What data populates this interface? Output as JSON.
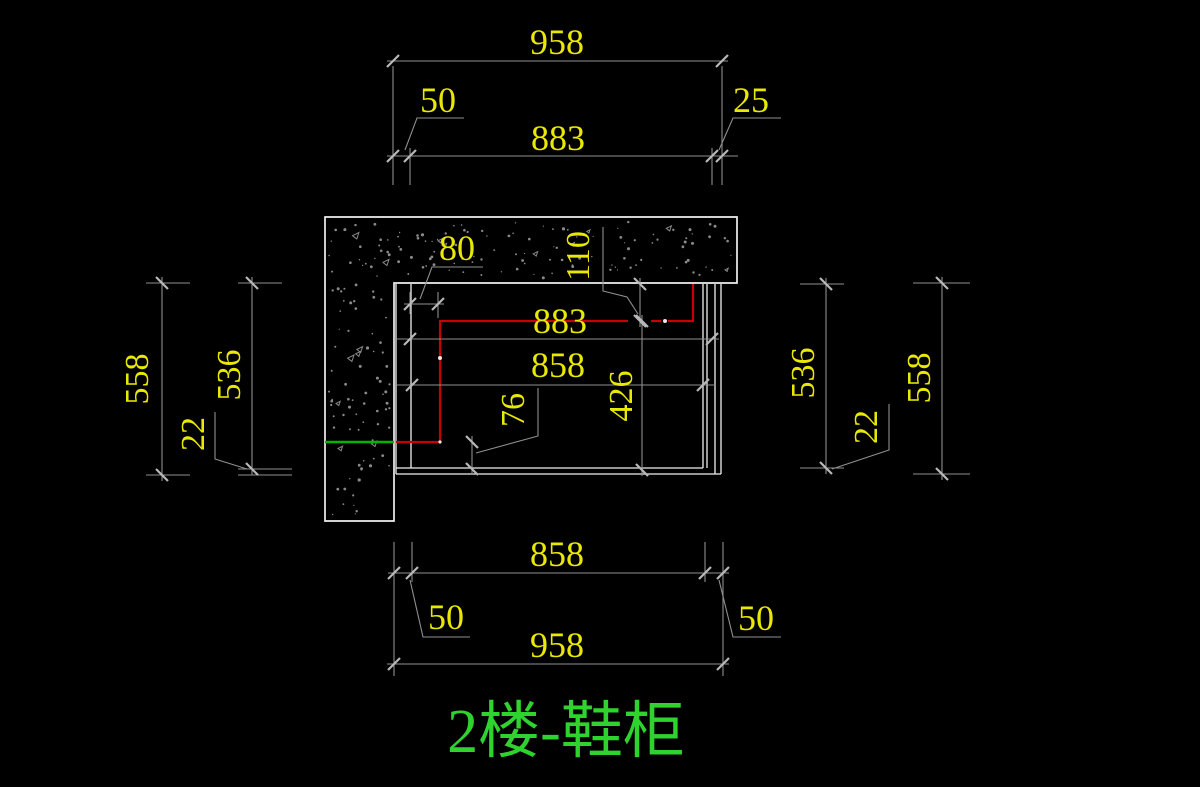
{
  "drawing_title": {
    "text": "2楼-鞋柜"
  },
  "colors": {
    "bg": "#000000",
    "geometry": "#f0f0f0",
    "dim_line": "#8f8f8f",
    "tick": "#b8b8b8",
    "dim_text": "#e8e800",
    "red_line": "#c80000",
    "green_line": "#00b400",
    "hatch": "#8a8a8a",
    "title_green": "#2ed32e"
  },
  "dims": {
    "top": {
      "d958": "958",
      "d50": "50",
      "d883": "883",
      "d25": "25"
    },
    "left": {
      "d558": "558",
      "d536": "536",
      "d22": "22"
    },
    "right": {
      "d536": "536",
      "d22": "22",
      "d558": "558"
    },
    "inner": {
      "d80": "80",
      "d110": "110",
      "d883": "883",
      "d858": "858",
      "d426": "426",
      "d76": "76"
    },
    "bottom": {
      "d858": "858",
      "d50_left": "50",
      "d50_right": "50",
      "d958": "958"
    }
  }
}
